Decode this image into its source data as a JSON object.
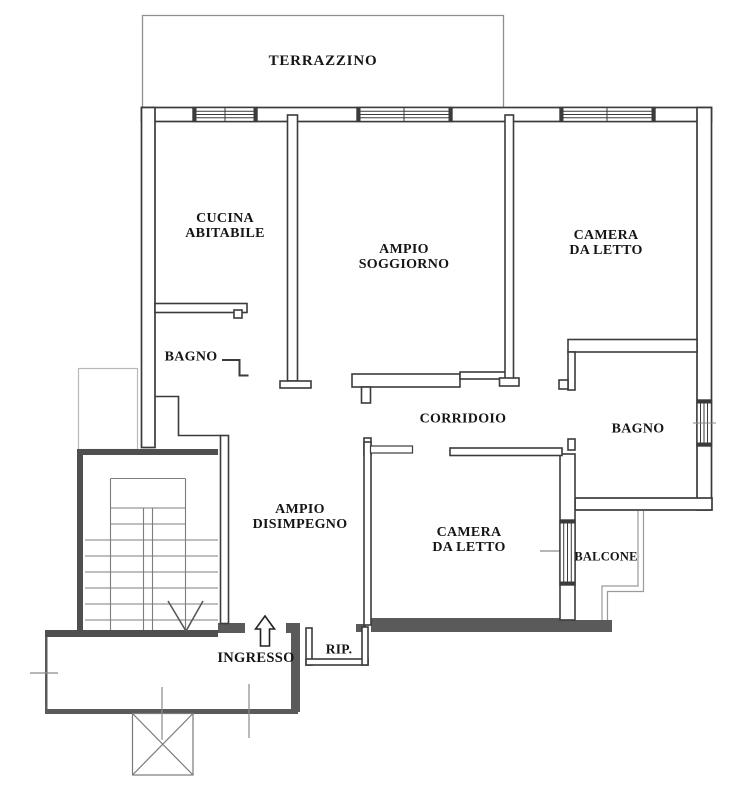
{
  "rooms": {
    "terrazzino": {
      "label": "TERRAZZINO"
    },
    "cucina": {
      "label": "CUCINA\nABITABILE"
    },
    "soggiorno": {
      "label": "AMPIO\nSOGGIORNO"
    },
    "camera_nord": {
      "label": "CAMERA\nDA LETTO"
    },
    "bagno_ovest": {
      "label": "BAGNO"
    },
    "corridoio": {
      "label": "CORRIDOIO"
    },
    "bagno_est": {
      "label": "BAGNO"
    },
    "disimpegno": {
      "label": "AMPIO\nDISIMPEGNO"
    },
    "camera_sud": {
      "label": "CAMERA\nDA LETTO"
    },
    "balcone": {
      "label": "BALCONE"
    },
    "ingresso": {
      "label": "INGRESSO"
    },
    "ripostiglio": {
      "label": "RIP."
    }
  },
  "icons": {
    "entrance_arrow": "up-arrow-entry-direction",
    "staircase": "double-flight-stairs-with-down-arrow",
    "shaft_box": "crossed-square-shaft"
  },
  "colors": {
    "wall_line": "#3b3b3b",
    "wall_fill": "#5a5a5a",
    "thin_line": "#9a9a9a",
    "light_line": "#b8b8b8",
    "label_text": "#151515",
    "background": "#ffffff"
  }
}
